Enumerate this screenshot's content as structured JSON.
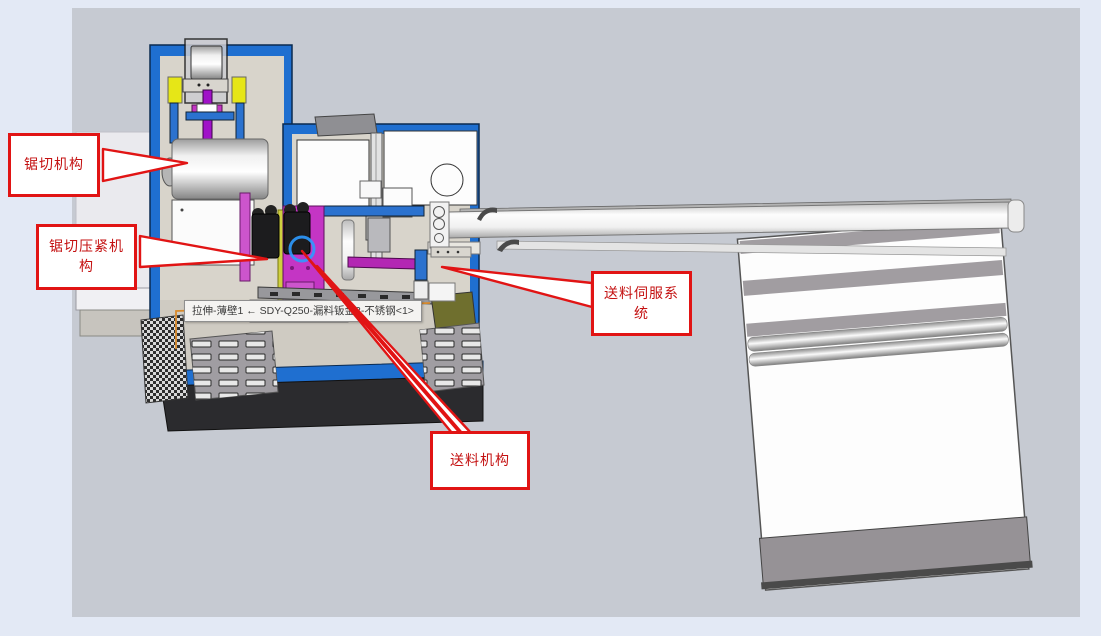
{
  "viewport": {
    "background": "#c6cad2",
    "page_background": "#e3e9f5"
  },
  "callouts": [
    {
      "id": "sawing-mechanism",
      "label": "锯切机构"
    },
    {
      "id": "sawing-clamp-mechanism",
      "label": "锯切压紧机构"
    },
    {
      "id": "feed-servo-system",
      "label": "送料伺服系统"
    },
    {
      "id": "feed-mechanism",
      "label": "送料机构"
    }
  ],
  "tooltip": {
    "text": "拉伸-薄壁1 ← SDY-Q250-漏料钣金2-不锈钢<1>"
  },
  "colors": {
    "callout_red": "#e11414",
    "callout_text_red": "#c41111",
    "frame_blue": "#1f6fd0",
    "selection_highlight_blue": "#2e9bff",
    "selected_edge_orange": "#d98a2b",
    "accent_magenta": "#c435c4",
    "accent_purple": "#a012c8",
    "accent_yellow": "#e6e617",
    "machine_beige": "#d8d4cb",
    "base_black": "#2b2b2e"
  }
}
